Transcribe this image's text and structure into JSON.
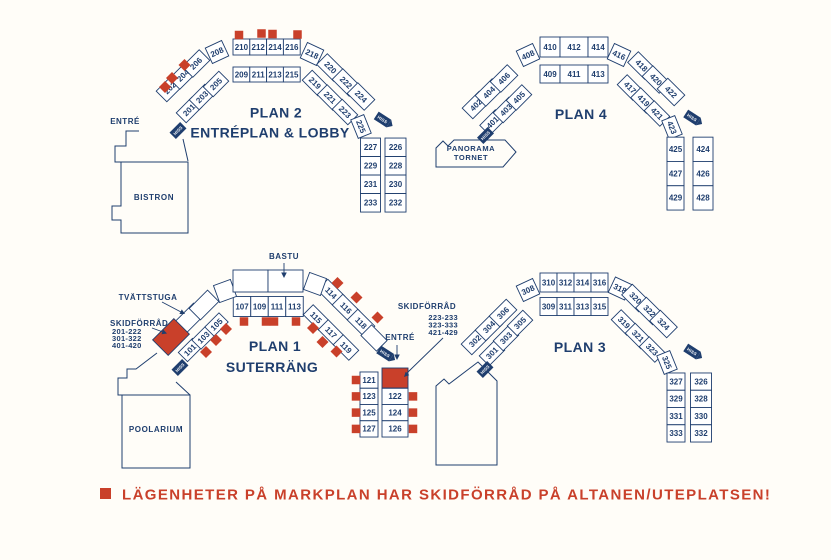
{
  "palette": {
    "navy": "#1f3e6e",
    "red": "#c9402a",
    "background": "#fffdf8",
    "cell_fill": "#ffffff"
  },
  "elevator_label": "HISS",
  "legend": {
    "marker": "red-square",
    "text": "LÄGENHETER PÅ MARKPLAN HAR SKIDFÖRRÅD PÅ ALTANEN/UTEPLATSEN!"
  },
  "annotations": {
    "entre_plan2": "ENTRÉ",
    "entre_plan1": "ENTRÉ",
    "bastu": "BASTU",
    "tvattstuga": "TVÄTTSTUGA",
    "skidforrad_left": {
      "title": "SKIDFÖRRÅD",
      "lines": [
        "201-222",
        "301-322",
        "401-420"
      ]
    },
    "skidforrad_right": {
      "title": "SKIDFÖRRÅD",
      "lines": [
        "223-233",
        "323-333",
        "421-429"
      ]
    }
  },
  "plans": [
    {
      "id": "plan2",
      "title": "PLAN 2",
      "subtitle": "ENTRÉPLAN & LOBBY",
      "facility": "BISTRON",
      "outer": [
        "202",
        "204",
        "206",
        "208",
        "210",
        "212",
        "214",
        "216",
        "218",
        "220",
        "222",
        "224"
      ],
      "inner": [
        "201",
        "203",
        "205",
        "209",
        "211",
        "213",
        "215",
        "219",
        "221",
        "223",
        "225"
      ],
      "col_left": [
        "227",
        "229",
        "231",
        "233"
      ],
      "col_right": [
        "226",
        "228",
        "230",
        "232"
      ]
    },
    {
      "id": "plan4",
      "title": "PLAN 4",
      "subtitle": "",
      "facility": "PANORAMA TORNET",
      "facility_lines": [
        "PANORAMA",
        "TORNET"
      ],
      "outer": [
        "402",
        "404",
        "406",
        "408",
        "410",
        "412",
        "414",
        "416",
        "418",
        "420",
        "422"
      ],
      "inner": [
        "401",
        "403",
        "405",
        "409",
        "411",
        "413",
        "417",
        "419",
        "421",
        "423"
      ],
      "col_left": [
        "425",
        "427",
        "429"
      ],
      "col_right": [
        "424",
        "426",
        "428"
      ]
    },
    {
      "id": "plan1",
      "title": "PLAN 1",
      "subtitle": "SUTERRÄNG",
      "facility": "POOLARIUM",
      "outer": [
        "114",
        "116",
        "118"
      ],
      "inner": [
        "101",
        "103",
        "105",
        "107",
        "109",
        "111",
        "113",
        "115",
        "117",
        "119"
      ],
      "col_left": [
        "121",
        "123",
        "125",
        "127"
      ],
      "col_right": [
        "122",
        "124",
        "126"
      ]
    },
    {
      "id": "plan3",
      "title": "PLAN 3",
      "subtitle": "",
      "facility": "",
      "outer": [
        "302",
        "304",
        "306",
        "308",
        "310",
        "312",
        "314",
        "316",
        "318",
        "320",
        "322",
        "324"
      ],
      "inner": [
        "301",
        "303",
        "305",
        "309",
        "311",
        "313",
        "315",
        "319",
        "321",
        "323",
        "325"
      ],
      "col_left": [
        "327",
        "329",
        "331",
        "333"
      ],
      "col_right": [
        "326",
        "328",
        "330",
        "332"
      ]
    }
  ]
}
